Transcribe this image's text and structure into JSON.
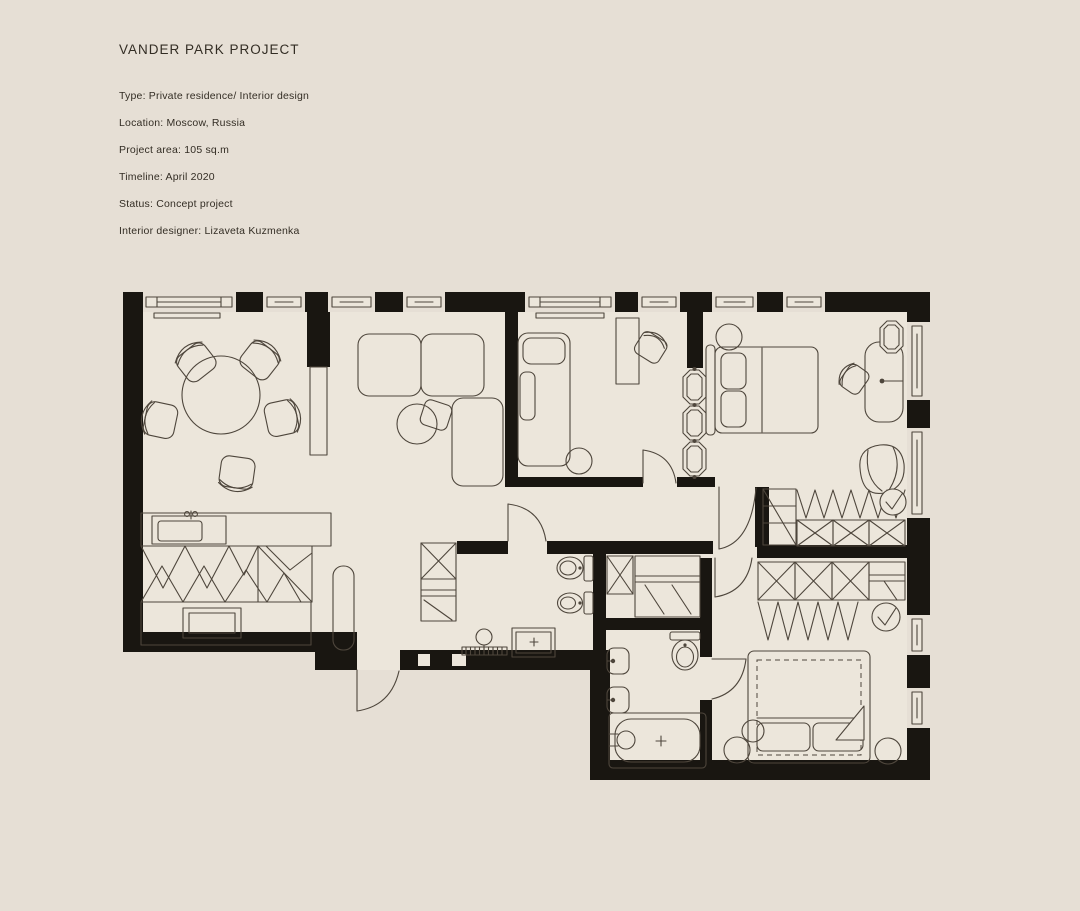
{
  "sheet": {
    "title": "VANDER PARK PROJECT",
    "details": [
      "Type: Private residence/ Interior design",
      "Location: Moscow, Russia",
      "Project area: 105 sq.m",
      "Timeline: April 2020",
      "Status: Concept project",
      "Interior designer: Lizaveta Kuzmenka"
    ]
  },
  "colors": {
    "background": "#e6dfd5",
    "floor": "#ece6db",
    "wall": "#191611",
    "line": "#4e463c",
    "text": "#332d24"
  }
}
